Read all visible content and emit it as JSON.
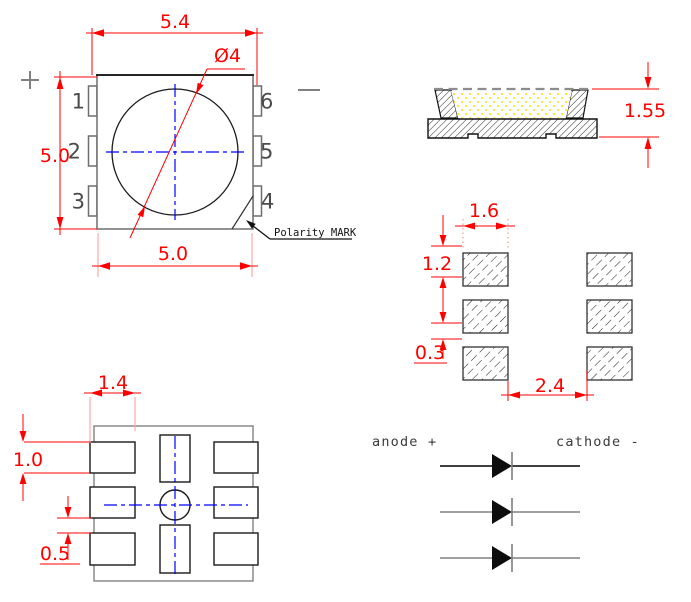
{
  "top_view": {
    "dim_overall_width": "5.4",
    "dim_body_height": "5.0",
    "dim_body_width": "5.0",
    "dim_lens_diameter": "Ø4",
    "polarity_mark_label": "Polarity MARK",
    "plus_sign": "+",
    "minus_sign": "−",
    "pins": [
      {
        "label": "1"
      },
      {
        "label": "2"
      },
      {
        "label": "3"
      },
      {
        "label": "4"
      },
      {
        "label": "5"
      },
      {
        "label": "6"
      }
    ]
  },
  "side_view": {
    "dim_height": "1.55"
  },
  "pad_layout": {
    "dim_pad_width": "1.6",
    "dim_pad_height": "1.2",
    "dim_pad_gap": "0.3",
    "dim_column_gap": "2.4"
  },
  "bottom_view": {
    "dim_pad_width": "1.4",
    "dim_pad_height": "1.0",
    "dim_pad_gap": "0.5"
  },
  "polarity_diagram": {
    "anode_label": "anode +",
    "cathode_label": "cathode -",
    "diode_count": 3
  },
  "colors": {
    "dimension_red": "#ff0000",
    "extension_pink": "#ffaaaa",
    "centerline_blue": "#0000ff",
    "outline_black": "#1a1a1a",
    "secondary_gray": "#808080",
    "encapsulant_yellow": "#ffe000"
  }
}
